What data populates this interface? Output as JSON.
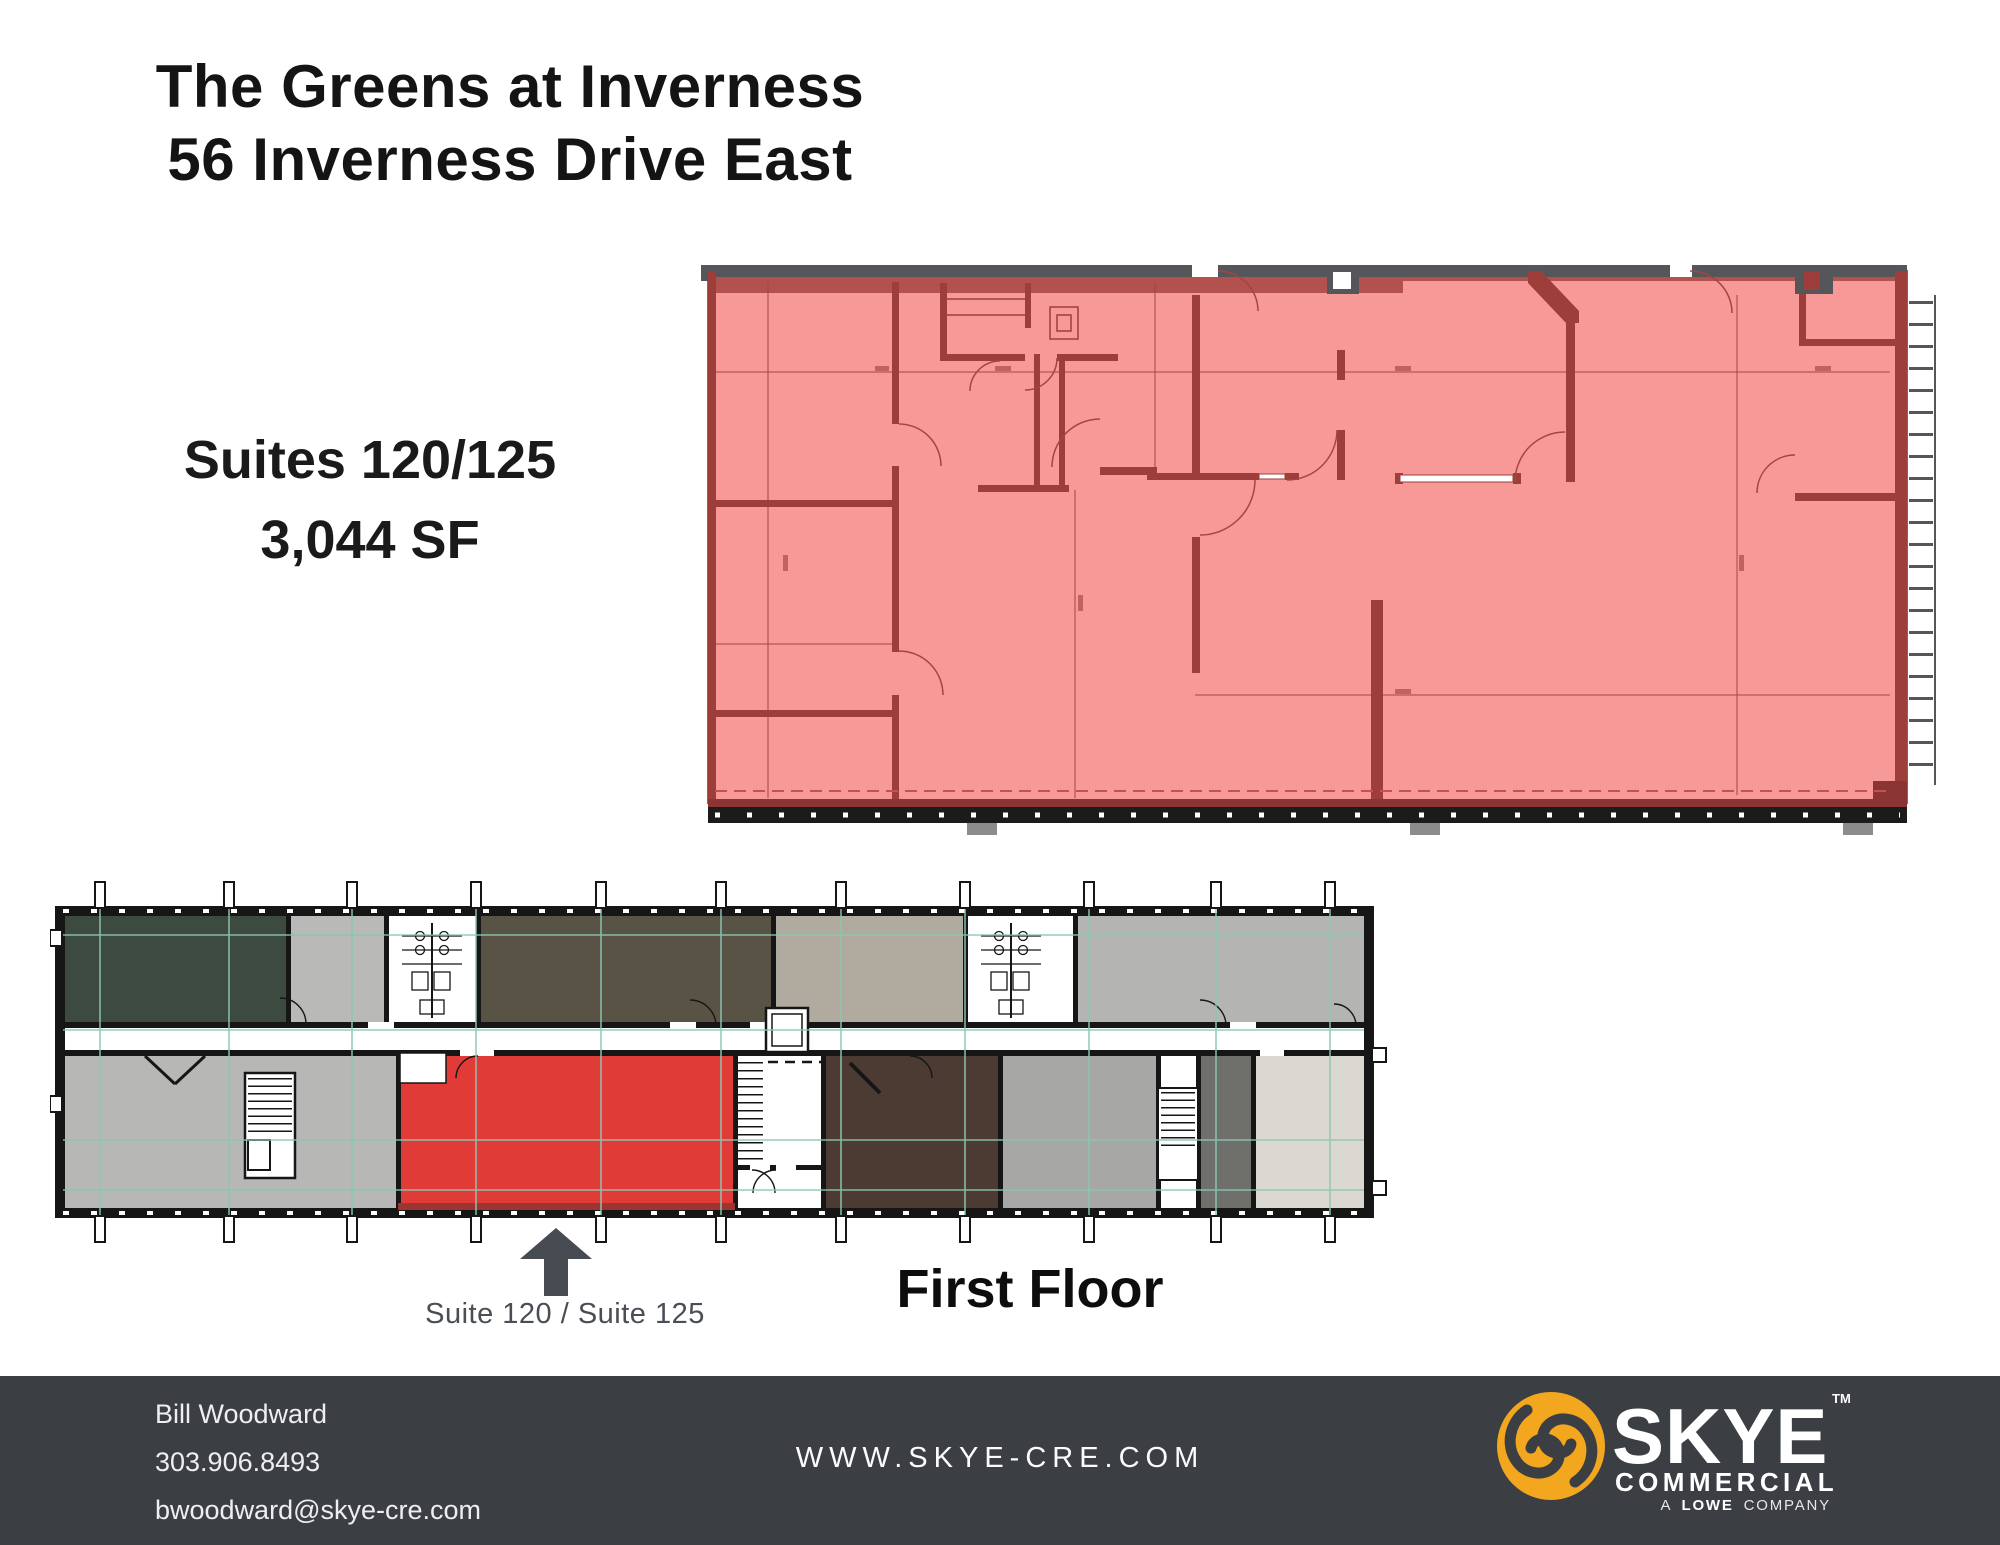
{
  "header": {
    "title_line1": "The Greens at Inverness",
    "title_line2": "56 Inverness Drive East"
  },
  "suite_info": {
    "suites": "Suites 120/125",
    "area": "3,044 SF"
  },
  "plan_callout": {
    "arrow_label": "Suite 120 / Suite 125",
    "floor_label": "First Floor"
  },
  "footer": {
    "contact": {
      "name": "Bill Woodward",
      "phone": "303.906.8493",
      "email": "bwoodward@skye-cre.com"
    },
    "website": "WWW.SKYE-CRE.COM",
    "logo": {
      "brand": "SKYE",
      "trademark": "TM",
      "division": "COMMERCIAL",
      "tagline_prefix": "A",
      "tagline_emphasis": "LOWE",
      "tagline_suffix": "COMPANY"
    }
  },
  "icons": {
    "pointer": "up-arrow-icon",
    "logo": "skye-swirl-icon"
  },
  "colors": {
    "highlight_red": "#e13b38",
    "plan_overlay_pink": "#f79a97",
    "plan_wall_red": "#9d3e3b",
    "plan_top_band_gray": "#55565a",
    "footer_background": "#3b3e43",
    "logo_yellow": "#f2a71e",
    "gridline_teal": "#8cc7b2"
  }
}
